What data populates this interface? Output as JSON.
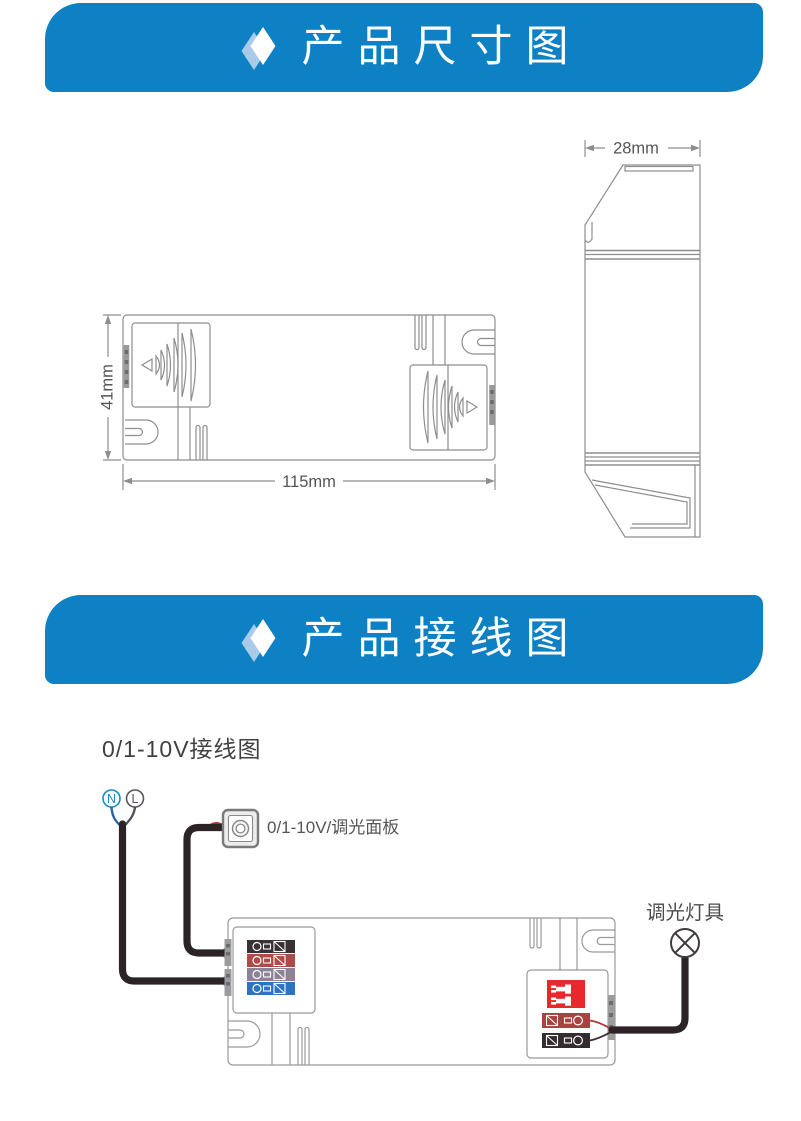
{
  "banners": {
    "dimensions": {
      "title": "产品尺寸图"
    },
    "wiring": {
      "title": "产品接线图"
    }
  },
  "dimensions": {
    "top_view": {
      "width_label": "115mm",
      "height_label": "41mm"
    },
    "side_view": {
      "depth_label": "28mm"
    }
  },
  "wiring": {
    "heading": "0/1-10V接线图",
    "neutral_label": "N",
    "live_label": "L",
    "panel_label": "0/1-10V/调光面板",
    "lamp_label": "调光灯具"
  },
  "icons": {
    "banner_marker": "diamond-icon",
    "dimmer_panel": "knob-panel-icon",
    "lamp": "crossed-circle-lamp-icon"
  },
  "colors": {
    "banner_blue": "#0e81c4",
    "diamond_shadow_blue": "#a9cbe7",
    "drawing_line_gray": "#8e8e8e",
    "wire_black": "#2b2326",
    "wire_blue": "#2a63ad",
    "wire_gray": "#56505c",
    "wire_red": "#b03a36",
    "terminal_black": "#3a3134",
    "terminal_red": "#ae4a47",
    "terminal_gray": "#8c8496",
    "terminal_blue": "#2e73c0",
    "output_row_red": "#a8433f",
    "output_row_black": "#342c2e",
    "warning_label_red": "#e8282c",
    "neutral_badge_blue": "#1b8ac6",
    "live_badge_gray": "#5a5560"
  }
}
